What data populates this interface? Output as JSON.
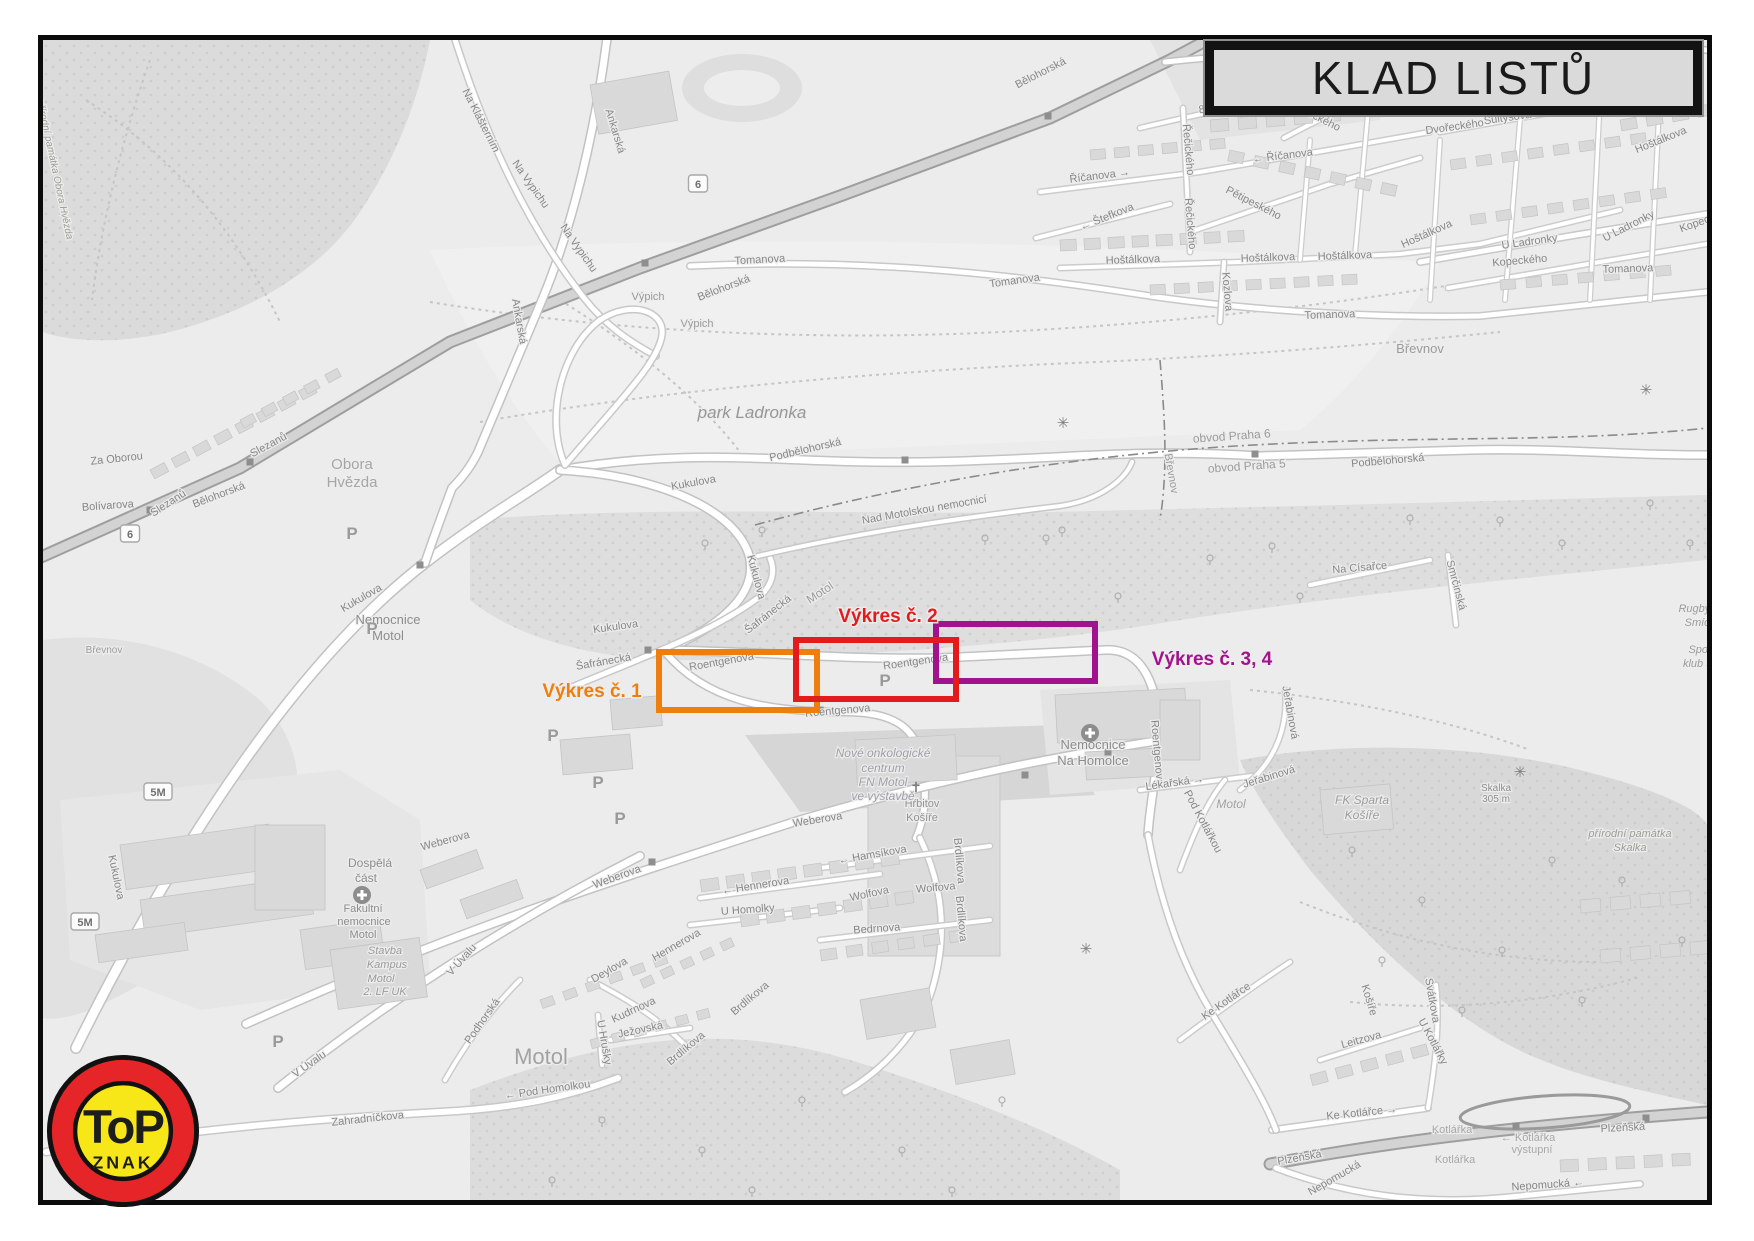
{
  "title": {
    "text": "KLAD LISTŮ"
  },
  "logo": {
    "top_text": "ToP",
    "bottom_text": "ZNAK",
    "ring_color": "#E52527",
    "inner_color": "#F7E719",
    "text_color": "#1d1d1b"
  },
  "overlays": [
    {
      "name": "vykres-1",
      "label": "Výkres č. 1",
      "color": "#EE7F0E",
      "box": [
        659,
        652,
        158,
        58
      ],
      "label_x": 592,
      "label_y": 697
    },
    {
      "name": "vykres-3-4",
      "label": "Výkres č. 3, 4",
      "color": "#A3128D",
      "box": [
        936,
        624,
        159,
        57
      ],
      "label_x": 1212,
      "label_y": 665
    },
    {
      "name": "vykres-2",
      "label": "Výkres č. 2",
      "color": "#E31B1C",
      "box": [
        796,
        640,
        160,
        59
      ],
      "label_x": 888,
      "label_y": 622
    }
  ],
  "map": {
    "road_badges": [
      {
        "t": "6",
        "x": 130,
        "y": 534
      },
      {
        "t": "6",
        "x": 698,
        "y": 184
      },
      {
        "t": "5M",
        "x": 158,
        "y": 792
      },
      {
        "t": "5M",
        "x": 85,
        "y": 922
      }
    ],
    "symbols": {
      "parking": [
        [
          352,
          533
        ],
        [
          372,
          628
        ],
        [
          553,
          735
        ],
        [
          598,
          782
        ],
        [
          620,
          818
        ],
        [
          278,
          1041
        ],
        [
          885,
          680
        ]
      ],
      "hospital": [
        [
          362,
          895
        ],
        [
          1090,
          733
        ]
      ],
      "church": [
        [
          916,
          787
        ]
      ],
      "viewpoint": [
        [
          1063,
          423
        ],
        [
          1520,
          772
        ],
        [
          1086,
          949
        ],
        [
          1646,
          390
        ]
      ],
      "crossing": [
        [
          1246,
          46
        ]
      ]
    },
    "labels": [
      {
        "t": "Za Oborou",
        "x": 117,
        "y": 462,
        "r": -6
      },
      {
        "t": "Slezanů",
        "x": 170,
        "y": 506,
        "r": -33
      },
      {
        "t": "Slezanů",
        "x": 270,
        "y": 448,
        "r": -28
      },
      {
        "t": "Bolívarova",
        "x": 108,
        "y": 509,
        "r": -4
      },
      {
        "t": "Bělohorská",
        "x": 220,
        "y": 498,
        "r": -21
      },
      {
        "t": "Bělohorská",
        "x": 725,
        "y": 291,
        "r": -21
      },
      {
        "t": "Bělohorská",
        "x": 1042,
        "y": 76,
        "r": -27
      },
      {
        "t": "Obora",
        "x": 352,
        "y": 469,
        "s": 15,
        "c": "#A6A6A6"
      },
      {
        "t": "Hvězda",
        "x": 352,
        "y": 487,
        "s": 15,
        "c": "#A6A6A6"
      },
      {
        "t": "přírodní památka Obora Hvězda",
        "x": 52,
        "y": 170,
        "r": 78,
        "s": 10,
        "st": "italic",
        "c": "#9C9C94"
      },
      {
        "t": "Na Klášterním",
        "x": 478,
        "y": 122,
        "r": 63
      },
      {
        "t": "Ankarská",
        "x": 612,
        "y": 132,
        "r": 73
      },
      {
        "t": "Ankarská",
        "x": 516,
        "y": 322,
        "r": 80
      },
      {
        "t": "Na Vypichu",
        "x": 528,
        "y": 186,
        "r": 55
      },
      {
        "t": "Na Vypichu",
        "x": 576,
        "y": 250,
        "r": 55
      },
      {
        "t": "Výpich",
        "x": 648,
        "y": 300,
        "c": "#9B9B9B"
      },
      {
        "t": "Výpich",
        "x": 697,
        "y": 327,
        "c": "#9B9B9B"
      },
      {
        "t": "park Ladronka",
        "x": 752,
        "y": 418,
        "s": 17,
        "st": "italic",
        "c": "#979797"
      },
      {
        "t": "Kukulova",
        "x": 694,
        "y": 486,
        "r": -10
      },
      {
        "t": "Kukulova",
        "x": 616,
        "y": 630,
        "r": -8
      },
      {
        "t": "Kukulova",
        "x": 753,
        "y": 578,
        "r": 75
      },
      {
        "t": "Kukulova",
        "x": 363,
        "y": 601,
        "r": -30
      },
      {
        "t": "Kukulova",
        "x": 113,
        "y": 878,
        "r": 78
      },
      {
        "t": "Podbělohorská",
        "x": 806,
        "y": 453,
        "r": -13
      },
      {
        "t": "Podbělohorská",
        "x": 1388,
        "y": 464,
        "r": -5
      },
      {
        "t": "Tomanova",
        "x": 760,
        "y": 263,
        "r": -3
      },
      {
        "t": "Tomanova",
        "x": 1015,
        "y": 284,
        "r": -8
      },
      {
        "t": "Tomanova",
        "x": 1330,
        "y": 318,
        "r": -2
      },
      {
        "t": "Tomanova",
        "x": 1628,
        "y": 272,
        "r": -2
      },
      {
        "t": "8. listopadu",
        "x": 1227,
        "y": 108,
        "r": -11
      },
      {
        "t": "Dvořeckého",
        "x": 1312,
        "y": 118,
        "r": 27
      },
      {
        "t": "Dvořeckého",
        "x": 1455,
        "y": 130,
        "r": -8
      },
      {
        "t": "Řečického",
        "x": 1185,
        "y": 150,
        "r": 85
      },
      {
        "t": "Řečického",
        "x": 1187,
        "y": 224,
        "r": 85
      },
      {
        "t": "Říčanova →",
        "x": 1100,
        "y": 179,
        "r": -7
      },
      {
        "t": "← Říčanova",
        "x": 1283,
        "y": 159,
        "r": -7
      },
      {
        "t": "Pětipeského",
        "x": 1252,
        "y": 206,
        "r": 27
      },
      {
        "t": "← Štefkova",
        "x": 1108,
        "y": 220,
        "r": -22
      },
      {
        "t": "Hoštálkova",
        "x": 1133,
        "y": 263,
        "r": -2
      },
      {
        "t": "Hoštálkova",
        "x": 1268,
        "y": 261,
        "r": -2
      },
      {
        "t": "Hoštálkova",
        "x": 1345,
        "y": 259,
        "r": -2
      },
      {
        "t": "Hoštálkova",
        "x": 1428,
        "y": 237,
        "r": -24
      },
      {
        "t": "Hoštálkova",
        "x": 1662,
        "y": 143,
        "r": -22
      },
      {
        "t": "Kozlova",
        "x": 1224,
        "y": 292,
        "r": 85
      },
      {
        "t": "Šultysova",
        "x": 1508,
        "y": 121,
        "r": -8
      },
      {
        "t": "U Ladronky",
        "x": 1530,
        "y": 245,
        "r": -8
      },
      {
        "t": "U Ladronky",
        "x": 1630,
        "y": 229,
        "r": -27
      },
      {
        "t": "Kopeckého",
        "x": 1520,
        "y": 264,
        "r": -5
      },
      {
        "t": "Kopeckého",
        "x": 1707,
        "y": 223,
        "r": -20
      },
      {
        "t": "Břevnovský",
        "x": 1243,
        "y": 100,
        "s": 13,
        "c": "#9A9A9A"
      },
      {
        "t": "klášter",
        "x": 1243,
        "y": 116,
        "s": 13,
        "c": "#9A9A9A"
      },
      {
        "t": "Břevnov",
        "x": 1420,
        "y": 353,
        "s": 13,
        "c": "#9B9B9B"
      },
      {
        "t": "Břevnov",
        "x": 1168,
        "y": 474,
        "r": 80,
        "c": "#9B9B9B"
      },
      {
        "t": "obvod Praha 6",
        "x": 1232,
        "y": 440,
        "r": -4,
        "s": 12,
        "c": "#9B9B9B"
      },
      {
        "t": "obvod Praha 5",
        "x": 1247,
        "y": 470,
        "r": -4,
        "s": 12,
        "c": "#9B9B9B"
      },
      {
        "t": "Břevnov",
        "x": 104,
        "y": 653,
        "s": 10,
        "c": "#9B9B9B"
      },
      {
        "t": "Nemocnice",
        "x": 388,
        "y": 624,
        "s": 13,
        "c": "#8C8C8C"
      },
      {
        "t": "Motol",
        "x": 388,
        "y": 640,
        "s": 13,
        "c": "#8C8C8C"
      },
      {
        "t": "Šafránecká",
        "x": 770,
        "y": 617,
        "r": -38
      },
      {
        "t": "Šafránecká",
        "x": 604,
        "y": 665,
        "r": -10
      },
      {
        "t": "Motol",
        "x": 822,
        "y": 596,
        "r": -33,
        "s": 12,
        "c": "#9B9B9B"
      },
      {
        "t": "Nad Motolskou nemocnicí",
        "x": 925,
        "y": 513,
        "r": -10
      },
      {
        "t": "Roentgenova",
        "x": 722,
        "y": 665,
        "r": -10
      },
      {
        "t": "Roentgenova",
        "x": 916,
        "y": 665,
        "r": -8
      },
      {
        "t": "Roentgenova",
        "x": 838,
        "y": 714,
        "r": -5
      },
      {
        "t": "Roentgenova",
        "x": 1154,
        "y": 753,
        "r": 85
      },
      {
        "t": "Nemocnice",
        "x": 1093,
        "y": 749,
        "s": 13,
        "c": "#8C8C8C"
      },
      {
        "t": "Na Homolce",
        "x": 1093,
        "y": 765,
        "s": 13,
        "c": "#8C8C8C"
      },
      {
        "t": "Lékařská →",
        "x": 1175,
        "y": 786,
        "r": -8
      },
      {
        "t": "Jeřabinová",
        "x": 1270,
        "y": 780,
        "r": -17
      },
      {
        "t": "Jeřabinová",
        "x": 1287,
        "y": 713,
        "r": 80
      },
      {
        "t": "FK Sparta",
        "x": 1362,
        "y": 804,
        "s": 12,
        "st": "italic",
        "c": "#9C9C9C"
      },
      {
        "t": "Košíře",
        "x": 1362,
        "y": 819,
        "s": 12,
        "st": "italic",
        "c": "#9C9C9C"
      },
      {
        "t": "Motol",
        "x": 1231,
        "y": 808,
        "s": 12,
        "st": "italic",
        "c": "#A2A2A2"
      },
      {
        "t": "Hřbitov",
        "x": 922,
        "y": 807,
        "c": "#929292"
      },
      {
        "t": "Košíře",
        "x": 922,
        "y": 821,
        "c": "#929292"
      },
      {
        "t": "Weberova",
        "x": 818,
        "y": 823,
        "r": -9
      },
      {
        "t": "Weberova",
        "x": 618,
        "y": 880,
        "r": -20
      },
      {
        "t": "Weberova",
        "x": 446,
        "y": 844,
        "r": -15
      },
      {
        "t": "← Hamsíkova",
        "x": 873,
        "y": 858,
        "r": -10
      },
      {
        "t": "← Hennerova",
        "x": 756,
        "y": 889,
        "r": -9
      },
      {
        "t": "Hennerova",
        "x": 678,
        "y": 948,
        "r": -30
      },
      {
        "t": "Wolfova",
        "x": 870,
        "y": 897,
        "r": -12
      },
      {
        "t": "Wolfova",
        "x": 936,
        "y": 891,
        "r": -5
      },
      {
        "t": "U Homolky",
        "x": 748,
        "y": 913,
        "r": -4
      },
      {
        "t": "Bedrnova",
        "x": 877,
        "y": 932,
        "r": -4
      },
      {
        "t": "Brdlíkova",
        "x": 956,
        "y": 861,
        "r": 85
      },
      {
        "t": "Brdlíkova",
        "x": 958,
        "y": 919,
        "r": 85
      },
      {
        "t": "Brdlíkova",
        "x": 752,
        "y": 1001,
        "r": -40
      },
      {
        "t": "Brdlíkova",
        "x": 688,
        "y": 1051,
        "r": -40
      },
      {
        "t": "Nové onkologické",
        "x": 883,
        "y": 757,
        "s": 12,
        "st": "italic",
        "c": "#9EA0A8"
      },
      {
        "t": "centrum",
        "x": 883,
        "y": 772,
        "s": 12,
        "st": "italic",
        "c": "#9EA0A8"
      },
      {
        "t": "FN Motol",
        "x": 883,
        "y": 786,
        "s": 12,
        "st": "italic",
        "c": "#9EA0A8"
      },
      {
        "t": "ve výstavbě",
        "x": 883,
        "y": 800,
        "s": 12,
        "st": "italic",
        "c": "#9EA0A8"
      },
      {
        "t": "Dospělá",
        "x": 370,
        "y": 867,
        "s": 12,
        "c": "#8C8C8C"
      },
      {
        "t": "část",
        "x": 366,
        "y": 882,
        "s": 12,
        "c": "#8C8C8C"
      },
      {
        "t": "Fakultní",
        "x": 363,
        "y": 912,
        "c": "#8C8C8C"
      },
      {
        "t": "nemocnice",
        "x": 364,
        "y": 925,
        "c": "#8C8C8C"
      },
      {
        "t": "Motol",
        "x": 363,
        "y": 938,
        "c": "#8C8C8C"
      },
      {
        "t": "Stavba",
        "x": 385,
        "y": 954,
        "st": "italic",
        "c": "#9A9A9A"
      },
      {
        "t": "Kampus",
        "x": 387,
        "y": 968,
        "st": "italic",
        "c": "#9A9A9A"
      },
      {
        "t": "Motol",
        "x": 381,
        "y": 982,
        "st": "italic",
        "c": "#9A9A9A"
      },
      {
        "t": "2. LF UK",
        "x": 385,
        "y": 995,
        "st": "italic",
        "c": "#9A9A9A"
      },
      {
        "t": "V Úvalu",
        "x": 464,
        "y": 962,
        "r": -48
      },
      {
        "t": "V Úvalu",
        "x": 311,
        "y": 1067,
        "r": -35
      },
      {
        "t": "Podhorská",
        "x": 485,
        "y": 1023,
        "r": -55
      },
      {
        "t": "Kudrnova",
        "x": 635,
        "y": 1013,
        "r": -25
      },
      {
        "t": "U Hrušky",
        "x": 601,
        "y": 1043,
        "r": 80
      },
      {
        "t": "Motol",
        "x": 541,
        "y": 1064,
        "s": 22,
        "c": "#A2A2A2"
      },
      {
        "t": "Deylova",
        "x": 611,
        "y": 973,
        "r": -30
      },
      {
        "t": "Ježovská",
        "x": 641,
        "y": 1033,
        "r": -12
      },
      {
        "t": "Zahradníčkova",
        "x": 368,
        "y": 1122,
        "r": -6
      },
      {
        "t": "← Pod Homolkou",
        "x": 548,
        "y": 1093,
        "r": -8
      },
      {
        "t": "Ke Kotlářce →",
        "x": 1362,
        "y": 1116,
        "r": -6
      },
      {
        "t": "Ke Kotlářce",
        "x": 1228,
        "y": 1004,
        "r": -35
      },
      {
        "t": "U Kotlářky",
        "x": 1430,
        "y": 1043,
        "r": 62
      },
      {
        "t": "Leitzova",
        "x": 1362,
        "y": 1043,
        "r": -15
      },
      {
        "t": "Kotlářka",
        "x": 1452,
        "y": 1133,
        "c": "#A8A8A8"
      },
      {
        "t": "← Kotlářka",
        "x": 1528,
        "y": 1141,
        "c": "#A8A8A8"
      },
      {
        "t": "výstupní",
        "x": 1532,
        "y": 1153,
        "c": "#A8A8A8"
      },
      {
        "t": "Kotlářka",
        "x": 1455,
        "y": 1163,
        "c": "#A8A8A8"
      },
      {
        "t": "Plzeňská",
        "x": 1300,
        "y": 1161,
        "r": -10
      },
      {
        "t": "Plzeňská",
        "x": 1623,
        "y": 1131,
        "r": -3
      },
      {
        "t": "Nepomucká",
        "x": 1336,
        "y": 1181,
        "r": -30
      },
      {
        "t": "Nepomucká ←",
        "x": 1548,
        "y": 1188,
        "r": -4
      },
      {
        "t": "Košíře",
        "x": 1366,
        "y": 1001,
        "r": 73
      },
      {
        "t": "Svátkova",
        "x": 1429,
        "y": 1001,
        "r": 80
      },
      {
        "t": "Pod Kotlářkou",
        "x": 1200,
        "y": 823,
        "r": 62
      },
      {
        "t": "přírodní památka",
        "x": 1630,
        "y": 837,
        "st": "italic",
        "c": "#9C9C94"
      },
      {
        "t": "Skalka",
        "x": 1630,
        "y": 851,
        "st": "italic",
        "c": "#9C9C94"
      },
      {
        "t": "Skalka",
        "x": 1496,
        "y": 791,
        "s": 10,
        "c": "#8F8F8F"
      },
      {
        "t": "305 m",
        "x": 1496,
        "y": 802,
        "s": 10,
        "c": "#8F8F8F"
      },
      {
        "t": "Rugby klub",
        "x": 1706,
        "y": 612,
        "st": "italic",
        "c": "#9C9C9C"
      },
      {
        "t": "Smíchov",
        "x": 1706,
        "y": 626,
        "st": "italic",
        "c": "#9C9C9C"
      },
      {
        "t": "Sportovní",
        "x": 1712,
        "y": 653,
        "st": "italic",
        "c": "#9C9C9C"
      },
      {
        "t": "klub Smíchov",
        "x": 1716,
        "y": 667,
        "st": "italic",
        "c": "#9C9C9C"
      },
      {
        "t": "Na Císařce",
        "x": 1360,
        "y": 571,
        "r": -5
      },
      {
        "t": "Smrčinská",
        "x": 1453,
        "y": 586,
        "r": 75
      }
    ]
  }
}
